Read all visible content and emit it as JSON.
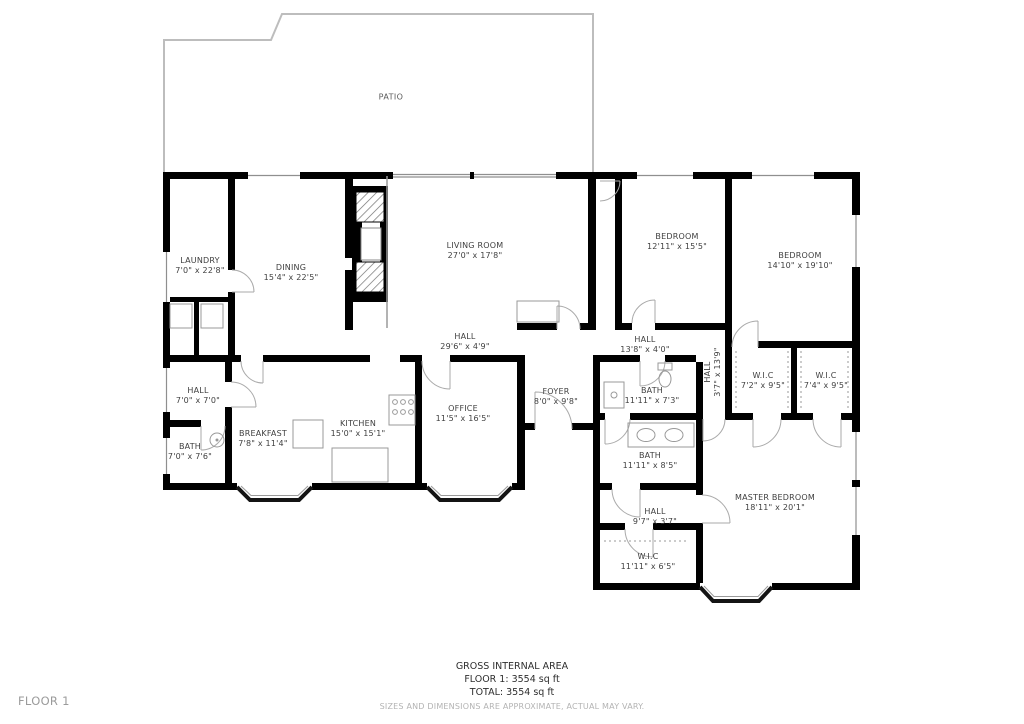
{
  "floor_indicator": "FLOOR 1",
  "patio": {
    "label": "PATIO"
  },
  "rooms": [
    {
      "name": "LAUNDRY",
      "dims": "7'0\" x 22'8\""
    },
    {
      "name": "DINING",
      "dims": "15'4\" x 22'5\""
    },
    {
      "name": "LIVING ROOM",
      "dims": "27'0\" x 17'8\""
    },
    {
      "name": "BEDROOM",
      "dims": "12'11\" x 15'5\""
    },
    {
      "name": "BEDROOM",
      "dims": "14'10\" x 19'10\""
    },
    {
      "name": "HALL",
      "dims": "29'6\" x 4'9\""
    },
    {
      "name": "HALL",
      "dims": "13'8\" x 4'0\""
    },
    {
      "name": "HALL",
      "dims": "3'7\" x 13'9\""
    },
    {
      "name": "W.I.C",
      "dims": "7'2\" x 9'5\""
    },
    {
      "name": "W.I.C",
      "dims": "7'4\" x 9'5\""
    },
    {
      "name": "HALL",
      "dims": "7'0\" x 7'0\""
    },
    {
      "name": "BATH",
      "dims": "7'0\" x 7'6\""
    },
    {
      "name": "BREAKFAST",
      "dims": "7'8\" x 11'4\""
    },
    {
      "name": "KITCHEN",
      "dims": "15'0\" x 15'1\""
    },
    {
      "name": "OFFICE",
      "dims": "11'5\" x 16'5\""
    },
    {
      "name": "FOYER",
      "dims": "8'0\" x 9'8\""
    },
    {
      "name": "BATH",
      "dims": "11'11\" x 7'3\""
    },
    {
      "name": "BATH",
      "dims": "11'11\" x 8'5\""
    },
    {
      "name": "MASTER BEDROOM",
      "dims": "18'11\" x 20'1\""
    },
    {
      "name": "HALL",
      "dims": "9'7\" x 3'7\""
    },
    {
      "name": "W.I.C",
      "dims": "11'11\" x 6'5\""
    }
  ],
  "footer": {
    "title": "GROSS INTERNAL AREA",
    "floor_line": "FLOOR 1: 3554 sq ft",
    "total_line": "TOTAL: 3554 sq ft",
    "disclaimer": "SIZES AND DIMENSIONS ARE APPROXIMATE, ACTUAL MAY VARY."
  },
  "colors": {
    "wall": "#000000",
    "patio_outline": "#bdbdbd",
    "door_arc": "#aaaaaa",
    "fixture": "#999999",
    "label_text": "#3f3f3f",
    "disclaimer_text": "#b3b3b3",
    "floor_text": "#9b9b9b"
  }
}
